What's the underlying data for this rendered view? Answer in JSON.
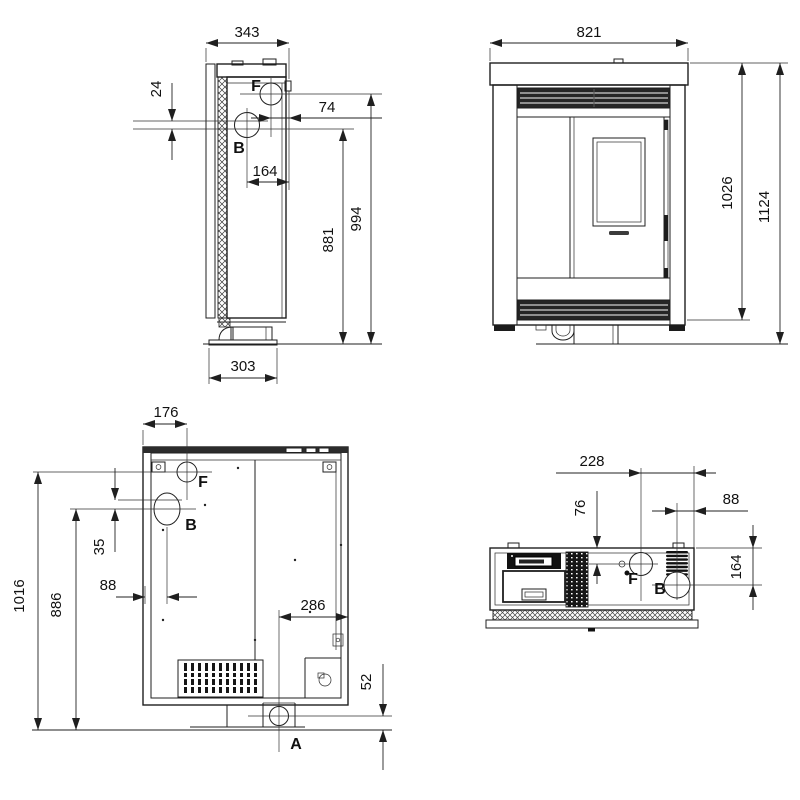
{
  "drawing": {
    "side_view": {
      "dim_depth_top": "343",
      "dim_port_offset": "24",
      "dim_f_to_front": "74",
      "dim_b_to_front": "164",
      "dim_height_b": "881",
      "dim_height_f": "994",
      "dim_base_depth": "303",
      "label_f": "F",
      "label_b": "B"
    },
    "front_view": {
      "dim_width": "821",
      "dim_height_body": "1026",
      "dim_height_total": "1124"
    },
    "rear_view": {
      "dim_f_from_left": "176",
      "dim_height_f": "1016",
      "dim_height_b": "886",
      "dim_port_offset": "35",
      "dim_b_from_left": "88",
      "dim_a_from_right": "286",
      "dim_a_height": "52",
      "label_f": "F",
      "label_b": "B",
      "label_a": "A"
    },
    "top_view": {
      "dim_f_from_right": "228",
      "dim_b_from_right": "88",
      "dim_f_from_front": "76",
      "dim_b_from_front": "164",
      "label_f": "F",
      "label_b": "B"
    }
  },
  "colors": {
    "line": "#1f1f1f",
    "dark_fill": "#1c1c1c",
    "background": "#ffffff"
  }
}
